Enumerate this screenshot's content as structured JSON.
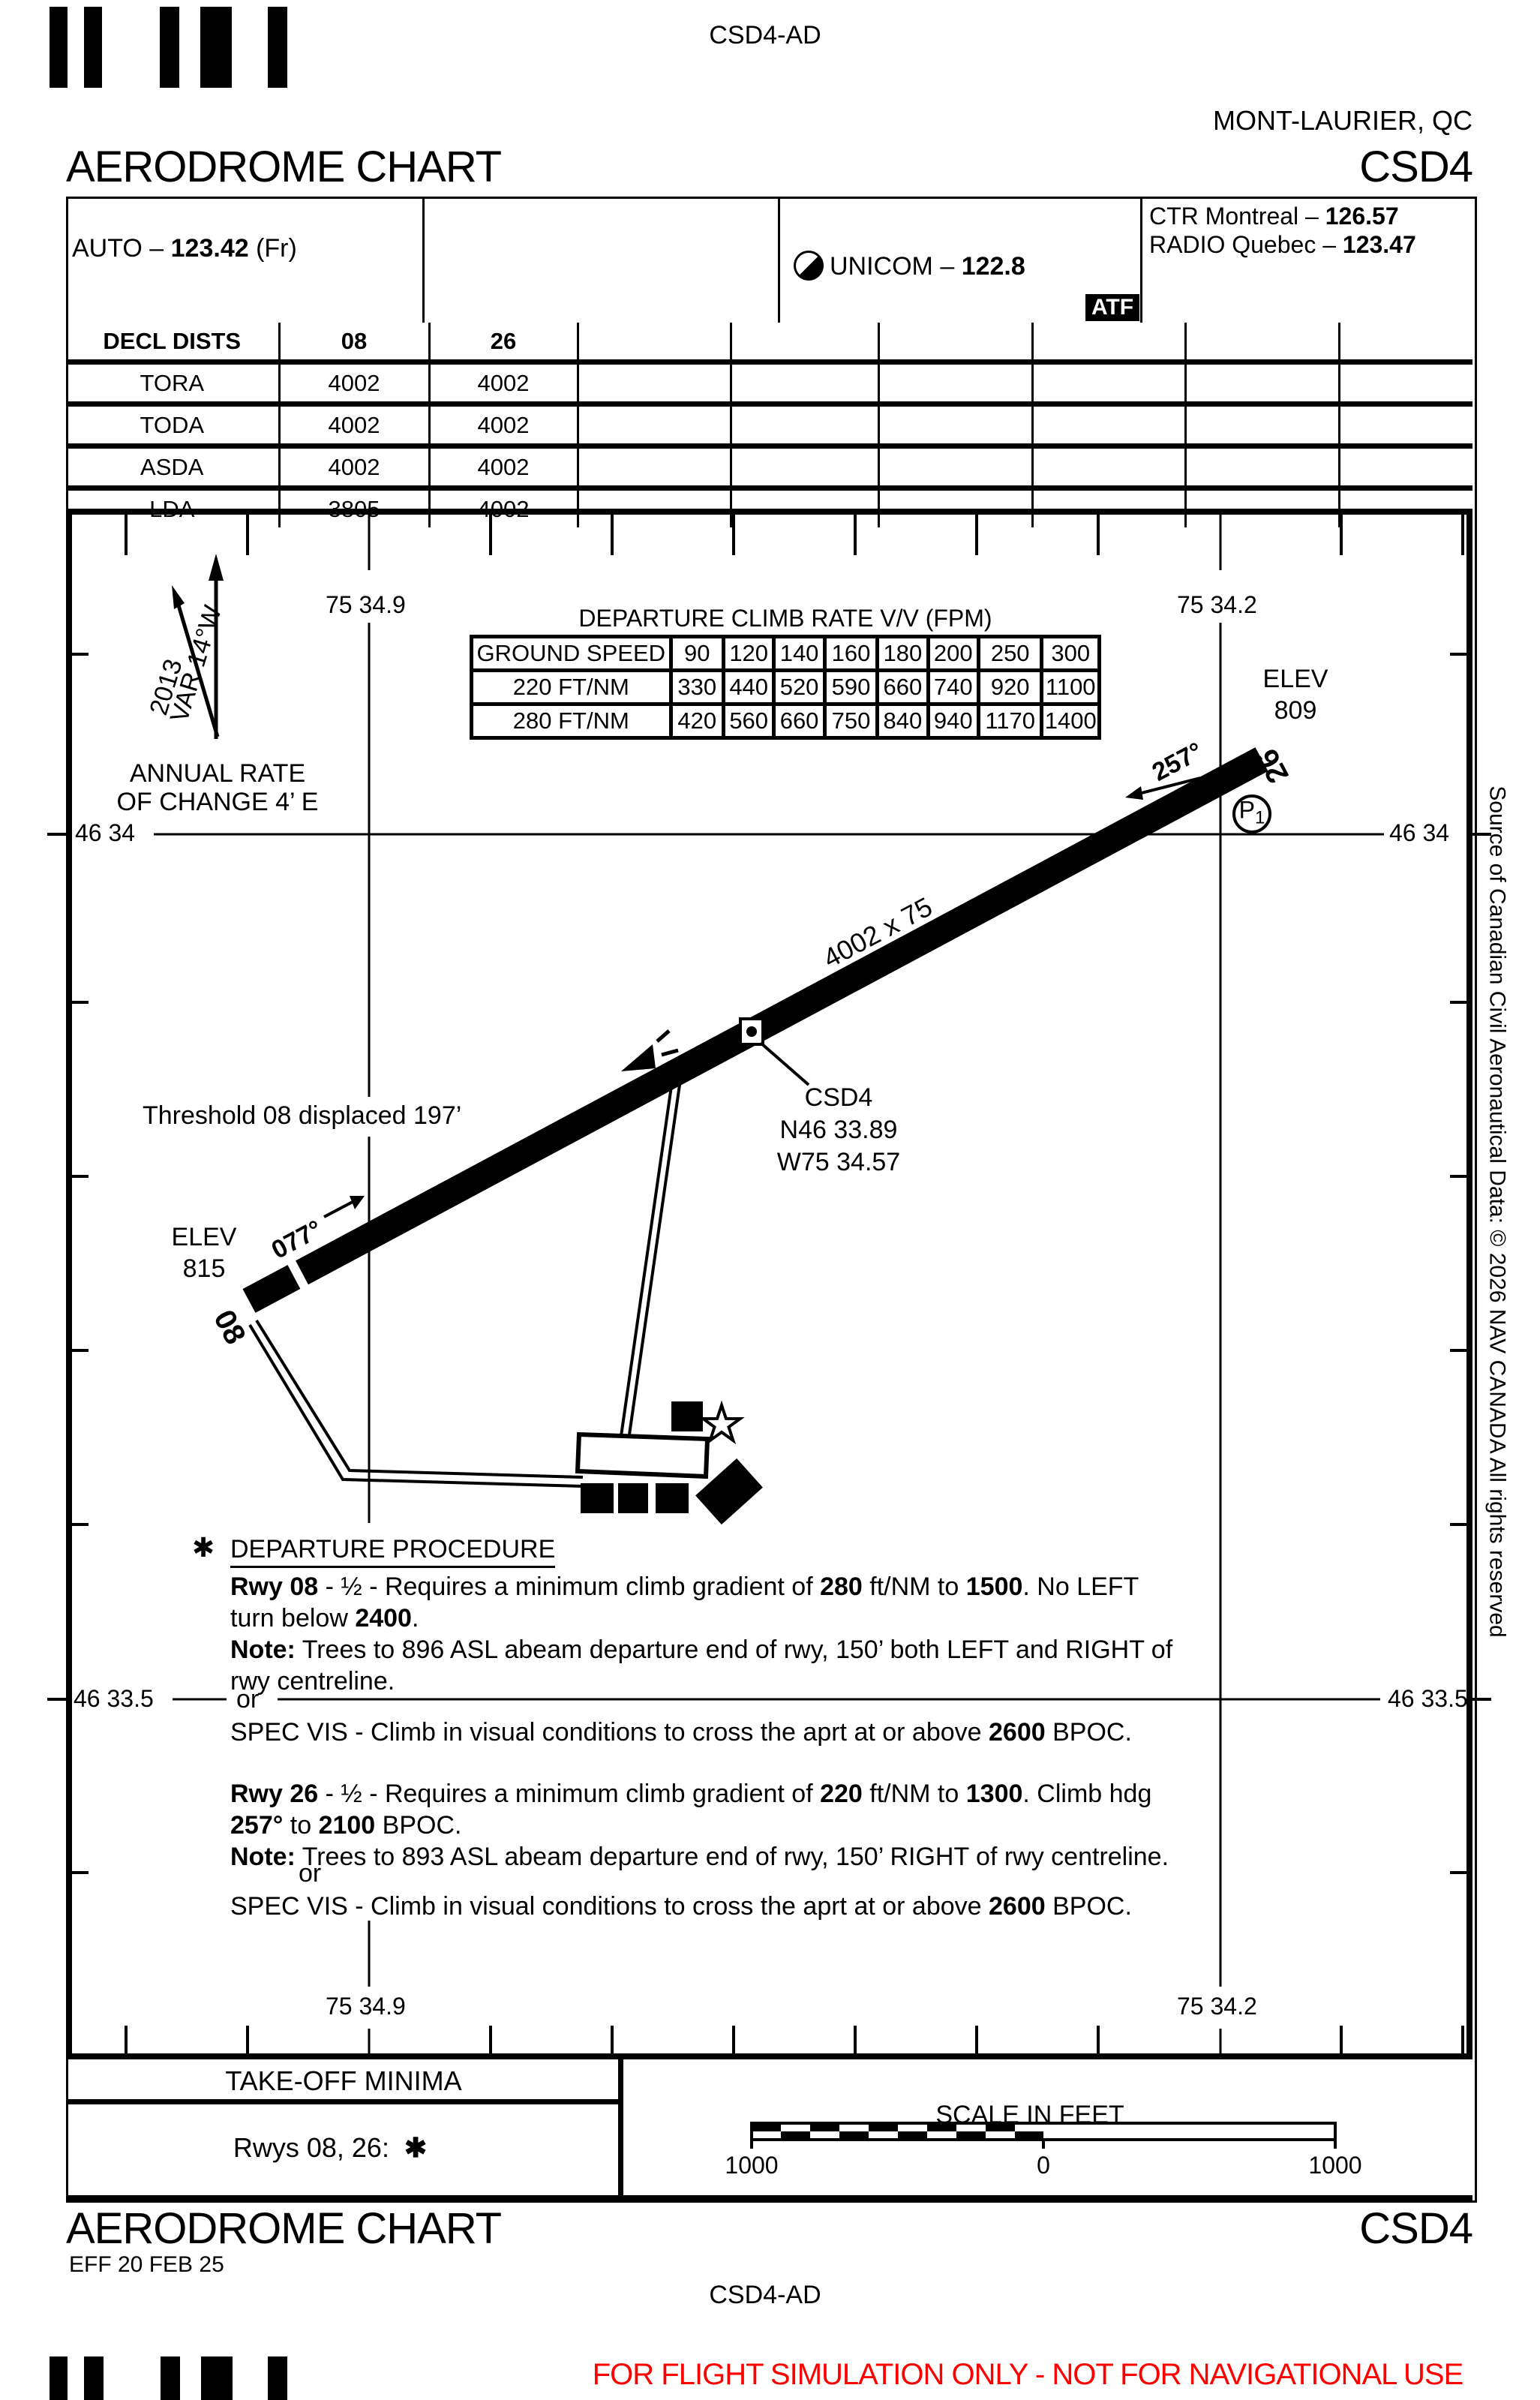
{
  "header": {
    "top_code": "CSD4-AD",
    "city": "MONT-LAURIER, QC",
    "title": "AERODROME CHART",
    "code": "CSD4"
  },
  "comm": {
    "auto_label": "AUTO –",
    "auto_freq": "123.42",
    "auto_suffix": "(Fr)",
    "unicom_label": "UNICOM –",
    "unicom_freq": "122.8",
    "ctr_label": "CTR Montreal –",
    "ctr_freq": "126.57",
    "radio_label": "RADIO Quebec –",
    "radio_freq": "123.47",
    "atf": "ATF"
  },
  "decl": {
    "header": [
      "DECL DISTS",
      "08",
      "26",
      "",
      "",
      "",
      "",
      "",
      ""
    ],
    "rows": [
      [
        "TORA",
        "4002",
        "4002"
      ],
      [
        "TODA",
        "4002",
        "4002"
      ],
      [
        "ASDA",
        "4002",
        "4002"
      ],
      [
        "LDA",
        "3805",
        "4002"
      ]
    ]
  },
  "climb_table": {
    "type": "table",
    "title": "DEPARTURE CLIMB RATE V/V (FPM)",
    "header": [
      "GROUND SPEED",
      "90",
      "120",
      "140",
      "160",
      "180",
      "200",
      "250",
      "300"
    ],
    "rows": [
      [
        "220 FT/NM",
        "330",
        "440",
        "520",
        "590",
        "660",
        "740",
        "920",
        "1100"
      ],
      [
        "280 FT/NM",
        "420",
        "560",
        "660",
        "750",
        "840",
        "940",
        "1170",
        "1400"
      ]
    ]
  },
  "map": {
    "lon_left": "75 34.9",
    "lon_right": "75 34.2",
    "lat_top": "46 34",
    "lat_bottom": "46 33.5",
    "var_label": "VAR 14°W",
    "var_year": "2013",
    "annual_rate_1": "ANNUAL RATE",
    "annual_rate_2": "OF CHANGE 4’ E",
    "elev_label": "ELEV",
    "elev_26": "809",
    "elev_08": "815",
    "rwy_dim": "4002 x 75",
    "rwy08": "08",
    "rwy26": "26",
    "hdg08": "077°",
    "hdg26": "257°",
    "threshold_note": "Threshold 08 displaced 197’",
    "arp_id": "CSD4",
    "arp_lat": "N46 33.89",
    "arp_lon": "W75 34.57",
    "parking": "P",
    "parking_sub": "1"
  },
  "departure": {
    "asterisk": "✱",
    "title": "DEPARTURE PROCEDURE",
    "or": "or",
    "rwy08": {
      "l1": [
        "Rwy 08",
        " - ½ - Requires a minimum climb gradient of ",
        "280",
        " ft/NM to  ",
        "1500",
        ". No LEFT"
      ],
      "l2": [
        "turn below ",
        "2400",
        "."
      ],
      "l3": [
        "Note:",
        " Trees to 896 ASL abeam departure end of rwy, 150’ both LEFT and RIGHT of"
      ],
      "l4": "rwy centreline.",
      "spec": [
        "SPEC VIS - Climb in visual conditions to cross the aprt at or above  ",
        "2600",
        " BPOC."
      ]
    },
    "rwy26": {
      "l1": [
        "Rwy 26",
        " - ½ - Requires a minimum climb gradient of ",
        "220",
        "  ft/NM to  ",
        "1300",
        ". Climb hdg"
      ],
      "l2": [
        "257°",
        " to  ",
        "2100",
        " BPOC."
      ],
      "l3": [
        "Note:",
        " Trees to 893 ASL abeam departure end of rwy, 150’ RIGHT of rwy centreline."
      ],
      "spec": [
        "SPEC VIS - Climb in visual conditions to cross the aprt at or above  ",
        "2600",
        " BPOC."
      ]
    }
  },
  "takeoff": {
    "title": "TAKE-OFF MINIMA",
    "entry": "Rwys 08, 26:",
    "star": "✱"
  },
  "scalebar": {
    "title": "SCALE IN FEET",
    "left": "1000",
    "mid": "0",
    "right": "1000"
  },
  "footer": {
    "title": "AERODROME CHART",
    "code": "CSD4",
    "eff": "EFF 20 FEB 25",
    "code_ad": "CSD4-AD",
    "disclaimer": "FOR FLIGHT SIMULATION ONLY - NOT FOR NAVIGATIONAL USE"
  },
  "source_note": "Source of Canadian Civil Aeronautical Data: © 2026 NAV CANADA All rights reserved",
  "colors": {
    "disclaimer_red": "#FF0000"
  }
}
